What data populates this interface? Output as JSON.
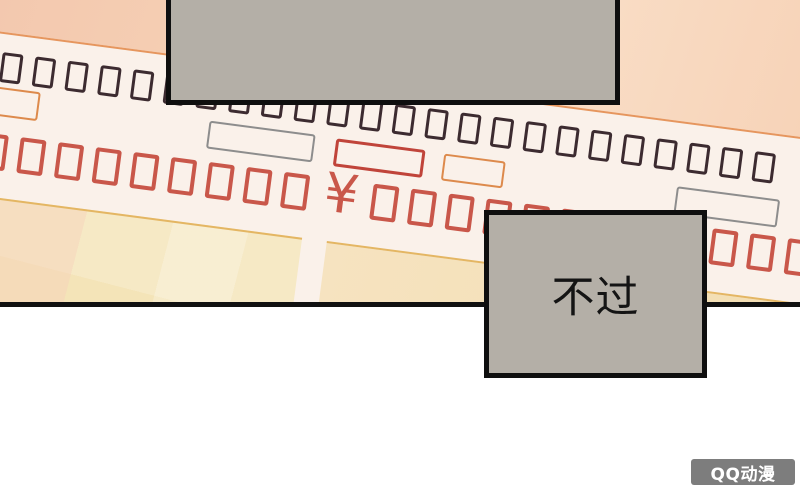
{
  "captions": {
    "top_box_text": "",
    "bottom_box_text": "不过"
  },
  "receipt": {
    "currency_symbol": "¥",
    "dark_glyph_row": {
      "count": 24,
      "color": "#3c2b30"
    },
    "red_glyph_row": {
      "left_count": 9,
      "right_count": 12,
      "color": "#c9574a"
    },
    "field_boxes": [
      {
        "name": "orange-field-left",
        "color": "#dd8a4c"
      },
      {
        "name": "gray-field-center",
        "color": "#8d8d8d"
      },
      {
        "name": "red-field-amount",
        "color": "#c0443a"
      },
      {
        "name": "orange-field-right",
        "color": "#dd8a4c"
      },
      {
        "name": "gray-field-right",
        "color": "#8d8d8d"
      }
    ]
  },
  "watermark": {
    "text": "QQ动漫"
  },
  "colors": {
    "page_bg": "#ffffff",
    "panel_divider": "#111111",
    "receipt_body": "#faf1ea",
    "header_left": "#f1c3ab",
    "header_right": "#f9dcc4",
    "header_edge": "#e6965e",
    "glyph_dark": "#3c2b30",
    "glyph_red": "#c9574a",
    "totals_left": "#f4e4b8",
    "totals_right": "#f2ddb0",
    "totals_edge": "#e4b663",
    "caption_fill": "#b4afa7",
    "caption_border": "#0f0f0f",
    "watermark_bg": "#7d7d7d",
    "watermark_text": "#ffffff"
  }
}
